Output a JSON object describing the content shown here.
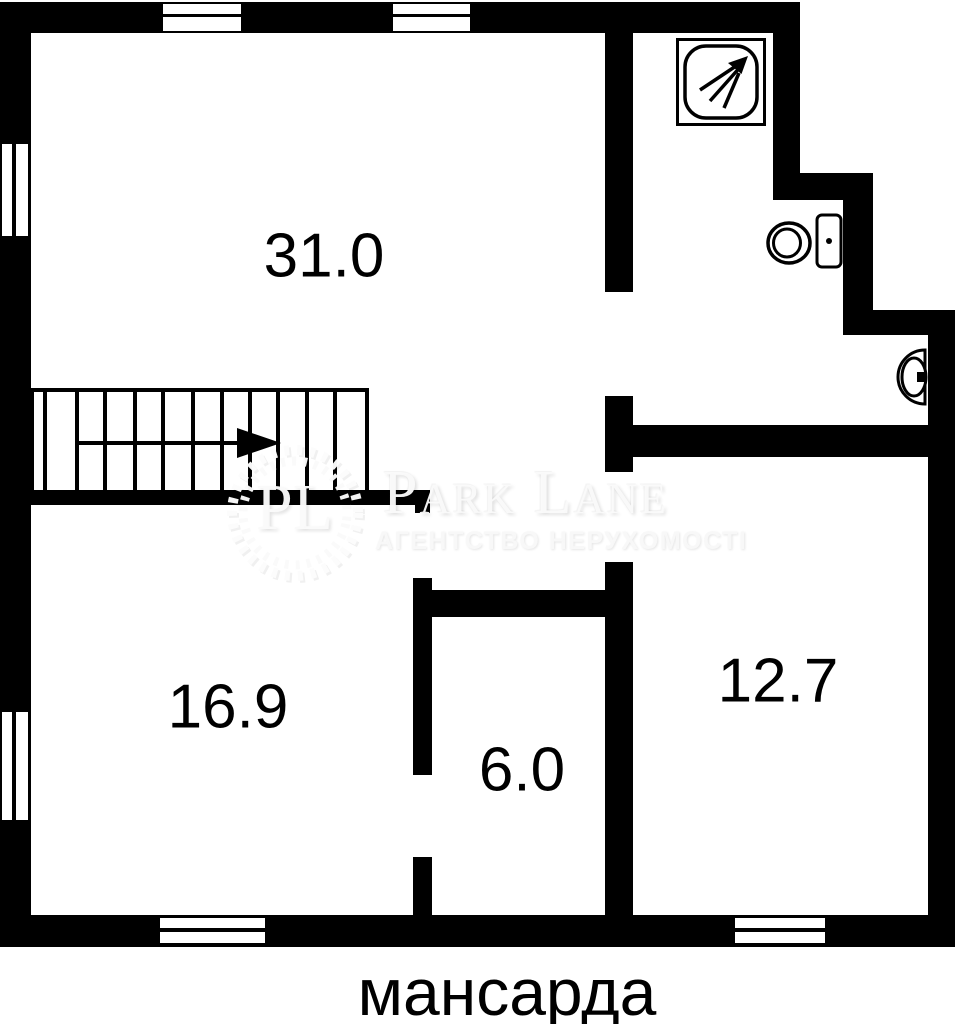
{
  "floor_label": "мансарда",
  "rooms": [
    {
      "area": "31.0"
    },
    {
      "area": "16.9"
    },
    {
      "area": "6.0"
    },
    {
      "area": "12.7"
    }
  ],
  "stairs": {
    "direction_arrow": "right"
  },
  "fixtures": {
    "shower": "shower",
    "toilet": "toilet",
    "sink": "sink"
  },
  "watermark": {
    "brand": "Park Lane",
    "monogram": "PL",
    "tagline": "АГЕНТСТВО НЕРУХОМОСТІ"
  },
  "colors": {
    "wall": "#000000",
    "background": "#ffffff",
    "label_text": "#000000",
    "watermark_text": "#f8f8f8"
  }
}
